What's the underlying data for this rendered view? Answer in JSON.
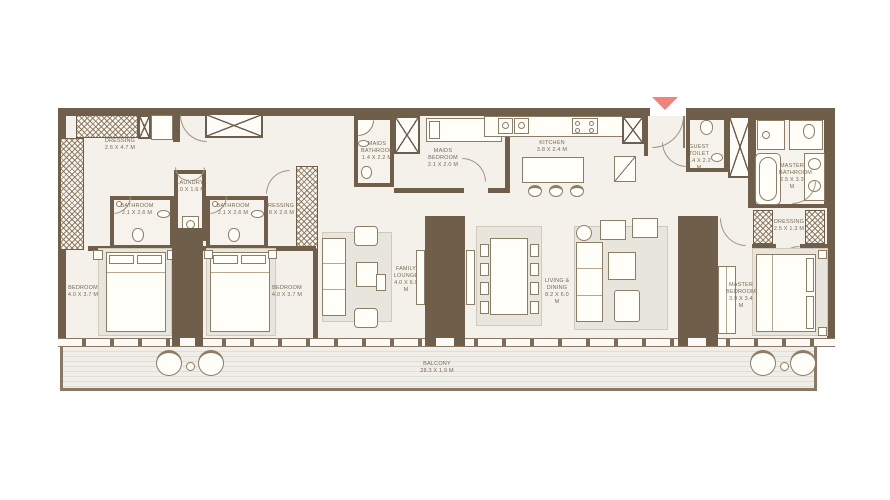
{
  "colors": {
    "wall": "#6f5e4a",
    "floor": "#f3f1ea",
    "rug": "#e8e5dc",
    "furniture_line": "#8d7d66",
    "label_text": "#7b6a55",
    "entry_arrow": "#f0837e",
    "balcony_deck": "#e0ddd4"
  },
  "rooms": {
    "dressing_left": {
      "name": "DRESSING",
      "dims": "2.6 x 4.7 M"
    },
    "laundry": {
      "name": "LAUNDRY",
      "dims": "1.0 x 1.6 M"
    },
    "bathroom_1": {
      "name": "BATHROOM",
      "dims": "2.1 x 2.6 M"
    },
    "bathroom_2": {
      "name": "BATHROOM",
      "dims": "2.1 x 2.6 M"
    },
    "dressing_mid": {
      "name": "DRESSING",
      "dims": "1.8 x 2.6 M"
    },
    "bedroom_1": {
      "name": "BEDROOM",
      "dims": "4.0 x 3.7 M"
    },
    "bedroom_2": {
      "name": "BEDROOM",
      "dims": "4.0 x 3.7 M"
    },
    "family_lounge": {
      "name": "FAMILY LOUNGE",
      "dims": "4.0 x 6.0 M"
    },
    "maids_bathroom": {
      "name": "MAIDS BATHROOM",
      "dims": "1.4 x 2.2 M"
    },
    "maids_bedroom": {
      "name": "MAIDS BEDROOM",
      "dims": "2.1 x 2.0 M"
    },
    "kitchen": {
      "name": "KITCHEN",
      "dims": "3.8 x 2.4 M"
    },
    "living_dining": {
      "name": "LIVING & DINING",
      "dims": "8.2 x 6.0 M"
    },
    "guest_toilet": {
      "name": "GUEST TOILET",
      "dims": "1.4 x 2.2 M"
    },
    "master_bathroom": {
      "name": "MASTER BATHROOM",
      "dims": "2.5 x 3.3 M"
    },
    "dressing_master": {
      "name": "DRESSING",
      "dims": "2.5 x 1.3 M"
    },
    "master_bedroom": {
      "name": "MASTER BEDROOM",
      "dims": "3.9 x 3.4 M"
    },
    "balcony": {
      "name": "BALCONY",
      "dims": "28.3 x 1.9 M"
    }
  }
}
